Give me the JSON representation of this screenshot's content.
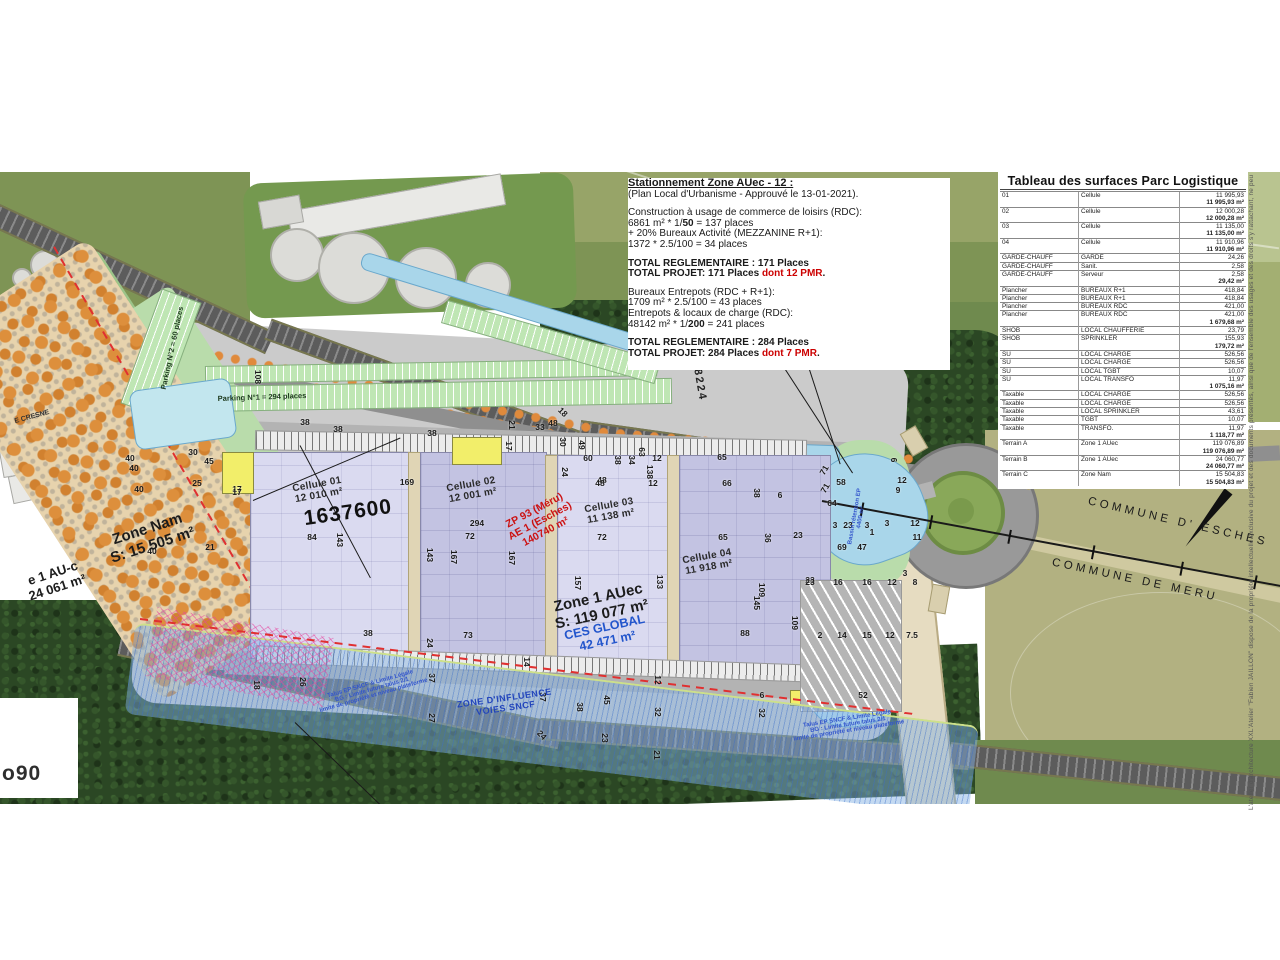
{
  "document": {
    "attribution": "L'atelier d'architecture XXL'Atelier \"Fabien JAILLON\" dispose de la propriété intellectuelle exclusive du projet et des documents présentés, ainsi que de l'ensemble des usages et des droits s'y rattachant, ne peut être reproduit sans autorisation.",
    "corner_logo": "o90"
  },
  "colors": {
    "accent_red": "#cc0000",
    "blue_note": "#2255cc",
    "building_light": "#dadaf0",
    "building_dark": "#c3c3e2",
    "orchard_orange": "#dd8f3c",
    "water": "#a9d6ea",
    "forest": "#2b4724"
  },
  "parking_note": {
    "title": "Stationnement Zone AUec - 12 :",
    "lines": [
      [
        {
          "t": "Stationnement Zone AUec - 12 :",
          "b": 1,
          "u": 1
        }
      ],
      [
        {
          "t": " (Plan Local d'Urbanisme - Approuvé le 13-01-2021)."
        }
      ],
      [],
      [
        {
          "t": "Construction à usage de commerce de loisirs (RDC):"
        }
      ],
      [
        {
          "t": "6861 m² * 1/"
        },
        {
          "t": "50",
          "b": 1
        },
        {
          "t": " = 137 places"
        }
      ],
      [
        {
          "t": " + 20% Bureaux Activité (MEZZANINE R+1):"
        }
      ],
      [
        {
          "t": "1372 * 2.5/100 = 34 places"
        }
      ],
      [],
      [
        {
          "t": "TOTAL REGLEMENTAIRE : 171 Places",
          "b": 1
        }
      ],
      [
        {
          "t": "TOTAL PROJET: 171 Places ",
          "b": 1
        },
        {
          "t": "dont 12 PMR",
          "b": 1,
          "r": 1
        },
        {
          "t": ".",
          "b": 1
        }
      ],
      [],
      [
        {
          "t": "Bureaux Entrepots (RDC + R+1):"
        }
      ],
      [
        {
          "t": "1709 m² * 2.5/100 = 43 places"
        }
      ],
      [
        {
          "t": "Entrepots & locaux de charge (RDC):"
        }
      ],
      [
        {
          "t": "48142 m² * 1/"
        },
        {
          "t": "200",
          "b": 1
        },
        {
          "t": " = 241 places"
        }
      ],
      [],
      [
        {
          "t": "TOTAL REGLEMENTAIRE : 284 Places",
          "b": 1
        }
      ],
      [
        {
          "t": "TOTAL PROJET: 284 Places ",
          "b": 1
        },
        {
          "t": "dont 7 PMR",
          "b": 1,
          "r": 1
        },
        {
          "t": ".",
          "b": 1
        }
      ]
    ]
  },
  "surface_table": {
    "title": "Tableau des surfaces Parc Logistique",
    "rows": [
      [
        "01",
        "Cellule",
        "11 995,93",
        0
      ],
      [
        "",
        "",
        "11 995,93 m²",
        1
      ],
      [
        "02",
        "Cellule",
        "12 000,28",
        0
      ],
      [
        "",
        "",
        "12 000,28 m²",
        1
      ],
      [
        "03",
        "Cellule",
        "11 135,00",
        0
      ],
      [
        "",
        "",
        "11 135,00 m²",
        1
      ],
      [
        "04",
        "Cellule",
        "11 910,96",
        0
      ],
      [
        "",
        "",
        "11 910,96 m²",
        1
      ],
      [
        "GARDE-CHAUFF",
        "GARDE",
        "24,26",
        0
      ],
      [
        "GARDE-CHAUFF",
        "Sanit.",
        "2,58",
        0
      ],
      [
        "GARDE-CHAUFF",
        "Serveur",
        "2,58",
        0
      ],
      [
        "",
        "",
        "29,42 m²",
        1
      ],
      [
        "Plancher",
        "BUREAUX R+1",
        "418,84",
        0
      ],
      [
        "Plancher",
        "BUREAUX R+1",
        "418,84",
        0
      ],
      [
        "Plancher",
        "BUREAUX RDC",
        "421,00",
        0
      ],
      [
        "Plancher",
        "BUREAUX RDC",
        "421,00",
        0
      ],
      [
        "",
        "",
        "1 679,68 m²",
        1
      ],
      [
        "SHOB",
        "LOCAL CHAUFFERIE",
        "23,79",
        0
      ],
      [
        "SHOB",
        "SPRINKLER",
        "155,93",
        0
      ],
      [
        "",
        "",
        "179,72 m²",
        1
      ],
      [
        "SU",
        "LOCAL CHARGE",
        "526,56",
        0
      ],
      [
        "SU",
        "LOCAL CHARGE",
        "526,56",
        0
      ],
      [
        "SU",
        "LOCAL TGBT",
        "10,07",
        0
      ],
      [
        "SU",
        "LOCAL TRANSFO",
        "11,97",
        0
      ],
      [
        "",
        "",
        "1 075,16 m²",
        1
      ],
      [
        "Taxable",
        "LOCAL CHARGE",
        "526,56",
        0
      ],
      [
        "Taxable",
        "LOCAL CHARGE",
        "526,56",
        0
      ],
      [
        "Taxable",
        "LOCAL SPRINKLER",
        "43,61",
        0
      ],
      [
        "Taxable",
        "TGBT",
        "10,07",
        0
      ],
      [
        "Taxable",
        "TRANSFO.",
        "11,97",
        0
      ],
      [
        "",
        "",
        "1 118,77 m²",
        1
      ],
      [
        "Terrain A",
        "Zone 1 AUec",
        "119 076,89",
        0
      ],
      [
        "",
        "",
        "119 076,89 m²",
        1
      ],
      [
        "Terrain B",
        "Zone 1 AUec",
        "24 060,77",
        0
      ],
      [
        "",
        "",
        "24 060,77 m²",
        1
      ],
      [
        "Terrain C",
        "Zone Nam",
        "15 504,83",
        0
      ],
      [
        "",
        "",
        "15 504,83 m²",
        1
      ]
    ]
  },
  "map": {
    "labels": [
      {
        "t": "Cellule 01\n12 010 m²",
        "x": 318,
        "y": 318,
        "rot": -10,
        "cls": "cell"
      },
      {
        "t": "1637600",
        "x": 348,
        "y": 341,
        "rot": -8,
        "cls": "big"
      },
      {
        "t": "Cellule 02\n12 001 m²",
        "x": 472,
        "y": 318,
        "rot": -10,
        "cls": "cell"
      },
      {
        "t": "ZP 93 (Méru)\nAE 1 (Esches)\n140740 m²",
        "x": 540,
        "y": 349,
        "rot": -28,
        "cls": "redlbl"
      },
      {
        "t": "Cellule 03\n11 138 m²",
        "x": 610,
        "y": 339,
        "rot": -10,
        "cls": "cell"
      },
      {
        "t": "Cellule 04\n11 918 m²",
        "x": 708,
        "y": 390,
        "rot": -10,
        "cls": "cell"
      },
      {
        "t": "Zone 1 AUec\nS: 119 077 m²",
        "x": 600,
        "y": 434,
        "rot": -12,
        "cls": "zone1"
      },
      {
        "t": "CES GLOBAL\n42 471 m²",
        "x": 606,
        "y": 462,
        "rot": -12,
        "cls": "ces"
      },
      {
        "t": "Zone Nam\nS: 15 505 m²",
        "x": 150,
        "y": 365,
        "rot": -18,
        "cls": "zonenam"
      },
      {
        "t": "e 1 AU-c\n24 061 m²",
        "x": 55,
        "y": 408,
        "rot": -18,
        "cls": "zonenam2"
      },
      {
        "t": "E CRESNE",
        "x": 32,
        "y": 245,
        "rot": -15,
        "cls": "tinyblack"
      },
      {
        "t": "COMMUNE  D'  ESCHES",
        "x": 1178,
        "y": 350,
        "rot": 13,
        "cls": "commune"
      },
      {
        "t": "COMMUNE  DE  MERU",
        "x": 1135,
        "y": 408,
        "rot": 12,
        "cls": "commune"
      },
      {
        "t": "Parking N°1 = 294 places",
        "x": 262,
        "y": 225,
        "rot": -2,
        "cls": "parkinglbl"
      },
      {
        "t": "Parking N°2 = 60 places",
        "x": 172,
        "y": 176,
        "rot": -78,
        "cls": "parkinglbl"
      },
      {
        "t": "ZONE D'INFLUENCE\nVOIES SNCF",
        "x": 505,
        "y": 531,
        "rot": -8,
        "cls": "sncf"
      },
      {
        "t": "Talus EP SNCF & Limite Légale\nBG : Limite future talus 2/1\nlimite de propriété et niveau plateforme",
        "x": 372,
        "y": 518,
        "rot": -16,
        "cls": "tinyblue"
      },
      {
        "t": "Talus EP SNCF & Limite Légale\nBG : Limite future talus 2/1\nlimite de propriété et niveau plateforme",
        "x": 848,
        "y": 553,
        "rot": -9,
        "cls": "tinyblue"
      },
      {
        "t": "Bassin rétention EP\n4400 m²",
        "x": 858,
        "y": 345,
        "rot": -80,
        "cls": "tinyblue"
      },
      {
        "t": "8224",
        "x": 700,
        "y": 213,
        "rot": 80,
        "cls": "roadnum"
      },
      {
        "t": "N",
        "x": 1216,
        "y": 306,
        "rot": 0,
        "cls": "north"
      }
    ],
    "numbers": [
      [
        40,
        130,
        286
      ],
      [
        40,
        134,
        296
      ],
      [
        40,
        139,
        317
      ],
      [
        40,
        152,
        379
      ],
      [
        30,
        193,
        280
      ],
      [
        45,
        209,
        289
      ],
      [
        25,
        197,
        311
      ],
      [
        21,
        210,
        375
      ],
      [
        17,
        237,
        317
      ],
      [
        108,
        258,
        205,
        90
      ],
      [
        38,
        305,
        250
      ],
      [
        38,
        338,
        257
      ],
      [
        38,
        432,
        261
      ],
      [
        21,
        512,
        253,
        90
      ],
      [
        17,
        509,
        274,
        90
      ],
      [
        33,
        540,
        255
      ],
      [
        48,
        553,
        251
      ],
      [
        18,
        563,
        240,
        45
      ],
      [
        30,
        563,
        270,
        90
      ],
      [
        49,
        582,
        273,
        90
      ],
      [
        60,
        588,
        286
      ],
      [
        38,
        618,
        288,
        90
      ],
      [
        34,
        632,
        288,
        90
      ],
      [
        63,
        642,
        280,
        90
      ],
      [
        12,
        657,
        286
      ],
      [
        138,
        650,
        300,
        90
      ],
      [
        24,
        565,
        300,
        90
      ],
      [
        48,
        602,
        308
      ],
      [
        169,
        407,
        310
      ],
      [
        84,
        312,
        365
      ],
      [
        143,
        340,
        368,
        90
      ],
      [
        294,
        477,
        351
      ],
      [
        72,
        470,
        364
      ],
      [
        143,
        430,
        383,
        90
      ],
      [
        167,
        454,
        385,
        90
      ],
      [
        167,
        512,
        386,
        90
      ],
      [
        17,
        237,
        320
      ],
      [
        38,
        368,
        461
      ],
      [
        73,
        468,
        463
      ],
      [
        72,
        602,
        365
      ],
      [
        157,
        578,
        411,
        90
      ],
      [
        133,
        660,
        410,
        90
      ],
      [
        65,
        723,
        365
      ],
      [
        65,
        722,
        285
      ],
      [
        36,
        768,
        366,
        90
      ],
      [
        23,
        810,
        408
      ],
      [
        145,
        757,
        431,
        90
      ],
      [
        109,
        762,
        418,
        90
      ],
      [
        88,
        745,
        461
      ],
      [
        109,
        795,
        451,
        90
      ],
      [
        23,
        798,
        363
      ],
      [
        48,
        600,
        311
      ],
      [
        12,
        653,
        311
      ],
      [
        66,
        727,
        311
      ],
      [
        38,
        757,
        321,
        90
      ],
      [
        6,
        780,
        323
      ],
      [
        24,
        430,
        471,
        90
      ],
      [
        37,
        432,
        506,
        90
      ],
      [
        14,
        527,
        490,
        90
      ],
      [
        37,
        543,
        525,
        90
      ],
      [
        38,
        580,
        535,
        90
      ],
      [
        45,
        607,
        528,
        90
      ],
      [
        12,
        658,
        508,
        90
      ],
      [
        32,
        658,
        540,
        90
      ],
      [
        27,
        432,
        546,
        90
      ],
      [
        24,
        542,
        563,
        45
      ],
      [
        23,
        605,
        566,
        90
      ],
      [
        21,
        657,
        583,
        90
      ],
      [
        26,
        303,
        510,
        90
      ],
      [
        18,
        257,
        513,
        90
      ],
      [
        23,
        810,
        410
      ],
      [
        16,
        838,
        410
      ],
      [
        16,
        867,
        410
      ],
      [
        12,
        892,
        410
      ],
      [
        3,
        905,
        401
      ],
      [
        8,
        915,
        410
      ],
      [
        2,
        820,
        463
      ],
      [
        14,
        842,
        463
      ],
      [
        15,
        867,
        463
      ],
      [
        12,
        890,
        463
      ],
      [
        7.5,
        912,
        463
      ],
      [
        52,
        863,
        523
      ],
      [
        32,
        762,
        541,
        90
      ],
      [
        6,
        762,
        523
      ],
      [
        58,
        841,
        310
      ],
      [
        71,
        824,
        298,
        -60
      ],
      [
        71,
        825,
        316,
        -60
      ],
      [
        64,
        832,
        331
      ],
      [
        3,
        835,
        353
      ],
      [
        23,
        848,
        353
      ],
      [
        3,
        867,
        353
      ],
      [
        3,
        887,
        351
      ],
      [
        1,
        872,
        360
      ],
      [
        69,
        842,
        375
      ],
      [
        47,
        862,
        375
      ],
      [
        12,
        902,
        308
      ],
      [
        9,
        898,
        318
      ],
      [
        12,
        915,
        351
      ],
      [
        11,
        917,
        365
      ],
      [
        6,
        894,
        288,
        90
      ]
    ]
  }
}
